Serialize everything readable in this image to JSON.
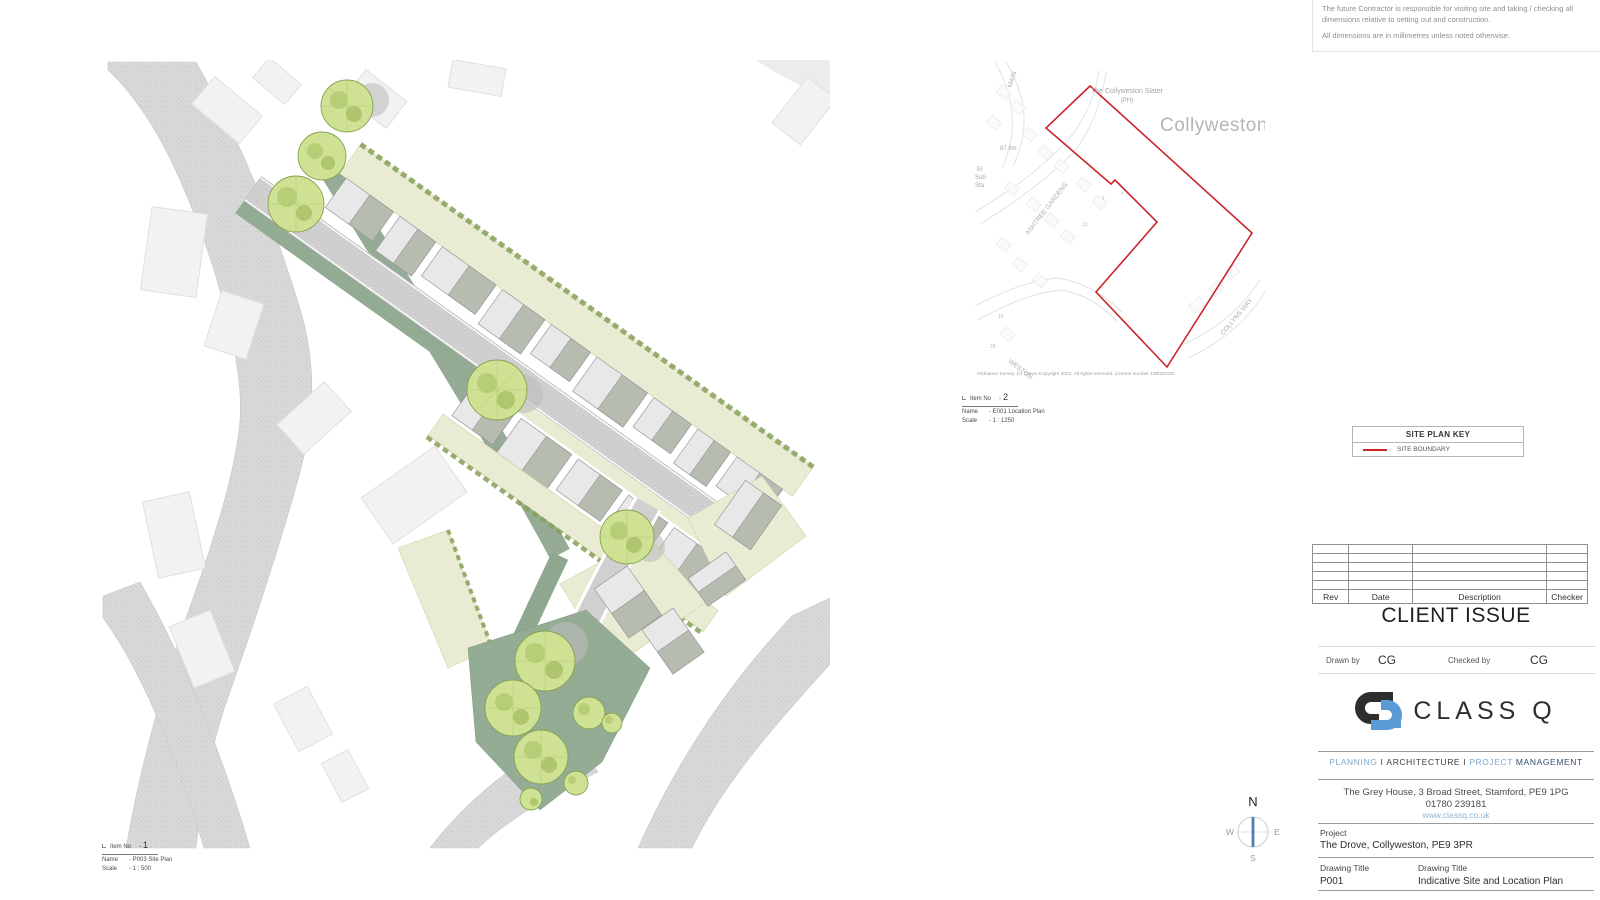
{
  "sheet": {
    "notes": [
      "The future Contractor is responsible for visiting site and taking / checking all dimensions relative to setting out and construction.",
      "All dimensions are in millimetres unless noted otherwise."
    ]
  },
  "site_plan_item": {
    "item_no_label": "Item No",
    "item_no": "1",
    "name_label": "Name",
    "name_value": "- P003 Site Plan",
    "scale_label": "Scale",
    "scale_value": "- 1 : 500"
  },
  "location_plan_item": {
    "item_no_label": "Item No",
    "item_no": "2",
    "name_label": "Name",
    "name_value": "- E001 Location Plan",
    "scale_label": "Scale",
    "scale_value": "- 1 : 1250"
  },
  "location_map": {
    "pub_name": "The Collyweston Slater",
    "pub_suffix": "(PH)",
    "town": "Collyweston",
    "spot_height": "87.8m",
    "substation_l1": "El",
    "substation_l2": "Sub",
    "substation_l3": "Sta",
    "street_ashtree": "ASHTREE GARDENS",
    "street_collyns": "COLLYNS WAY",
    "street_weston": "WESTON",
    "street_main": "MAIN",
    "plot_numbers": [
      "1",
      "4",
      "13",
      "28",
      "15"
    ],
    "copyright": "Ordnance Survey, (c) Crown Copyright 2021. All rights reserved. Licence number 100022432"
  },
  "site_key": {
    "title": "SITE PLAN KEY",
    "boundary_label": "SITE BOUNDARY",
    "boundary_color": "#c9252b"
  },
  "revision_table": {
    "headers": [
      "Rev",
      "Date",
      "Description",
      "Checker"
    ]
  },
  "title_block": {
    "status": "CLIENT ISSUE",
    "drawn_by_label": "Drawn by",
    "drawn_by_value": "CG",
    "checked_by_label": "Checked by",
    "checked_by_value": "CG",
    "logo_text": "CLASS Q",
    "services": {
      "s1": "PLANNING",
      "sep1": "I",
      "s2": "ARCHITECTURE",
      "sep2": "I",
      "s3": "PROJECT",
      "s4": "MANAGEMENT"
    },
    "address": "The Grey House, 3 Broad Street, Stamford, PE9 1PG",
    "phone": "01780 239181",
    "website": "www.classq.co.uk",
    "project_label": "Project",
    "project_value": "The Drove, Collyweston, PE9 3PR",
    "drawing_title_label": "Drawing Title",
    "drawing_number": "P001",
    "drawing_title_value": "Indicative Site and Location Plan",
    "brand_blue": "#5b9bd5",
    "brand_dark": "#2e2e2e",
    "tagline_blue": "#7fa8cc"
  },
  "compass": {
    "north": "N",
    "east": "E",
    "south": "S",
    "west": "W"
  }
}
